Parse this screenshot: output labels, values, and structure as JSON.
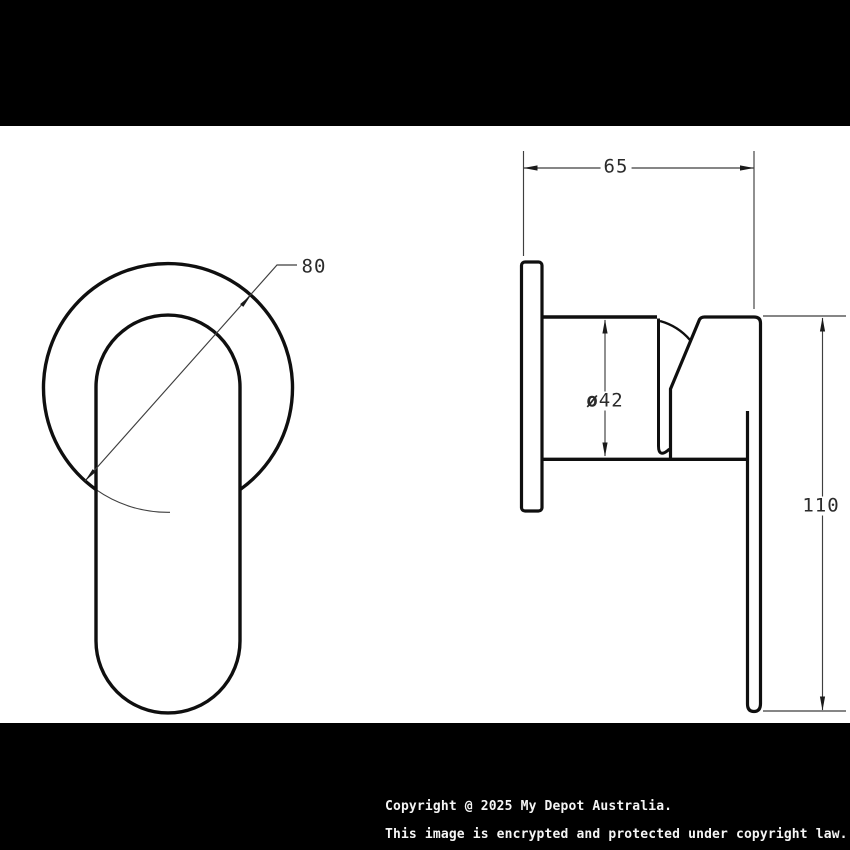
{
  "drawing": {
    "type": "technical drawing - wall mixer tap, front and side views",
    "dimensions": {
      "front_diameter": "80",
      "depth": "65",
      "body_diameter_symbol": "ø",
      "body_diameter_value": "42",
      "height": "110"
    }
  },
  "footer": {
    "line1": "Copyright @ 2025 My Depot Australia.",
    "line2": "This image is encrypted and protected under copyright law."
  },
  "colors": {
    "outline": "#0f0f0f",
    "dim_line": "#3f3f3f",
    "bar": "#000000",
    "footer_text": "#f5f5f5"
  }
}
